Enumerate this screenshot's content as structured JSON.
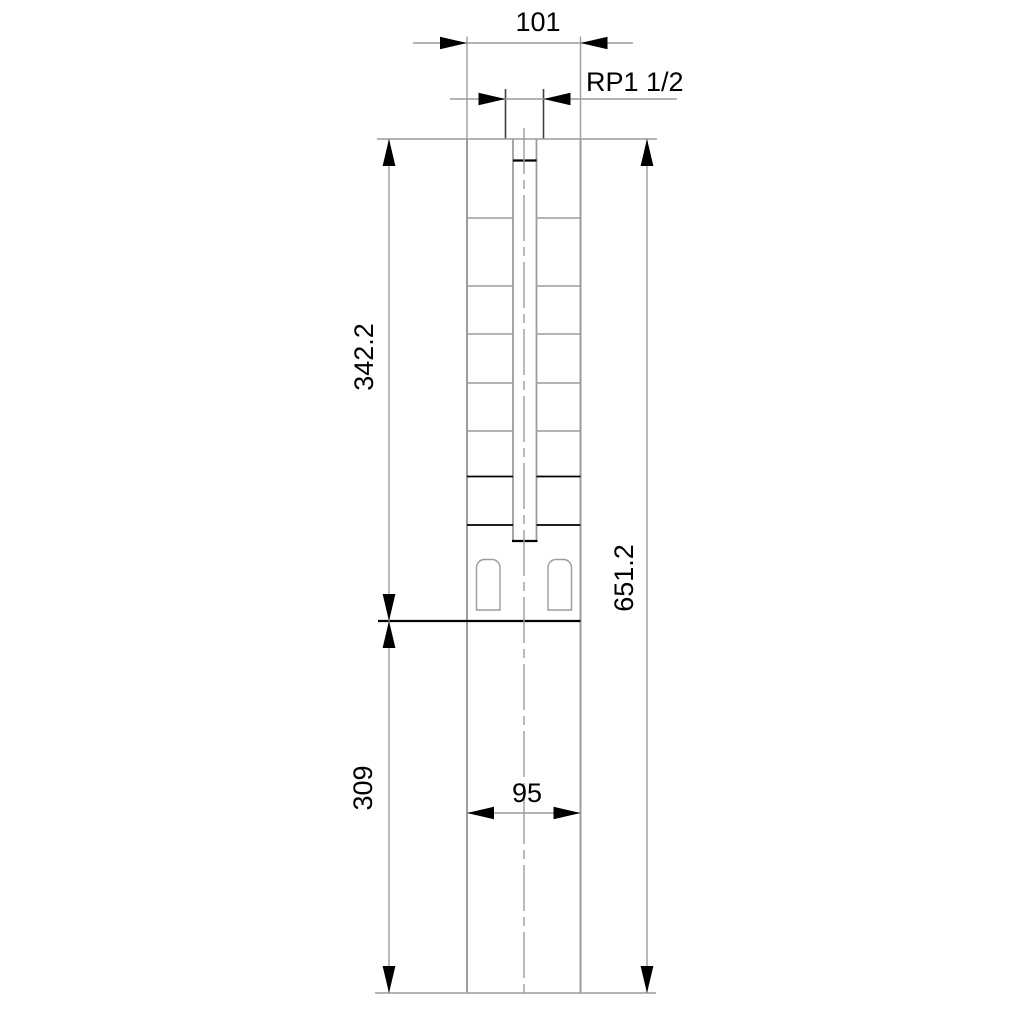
{
  "drawing": {
    "labels": {
      "top_width": "101",
      "thread": "RP1 1/2",
      "pump_section_length": "342.2",
      "overall_length": "651.2",
      "motor_section_length": "309",
      "motor_width": "95"
    },
    "colors": {
      "background": "#ffffff",
      "object_line_gray": "#9c9c9c",
      "object_line_dark": "#404040",
      "dimension_line_gray": "#9c9c9c",
      "arrow_and_text_black": "#000000"
    }
  }
}
